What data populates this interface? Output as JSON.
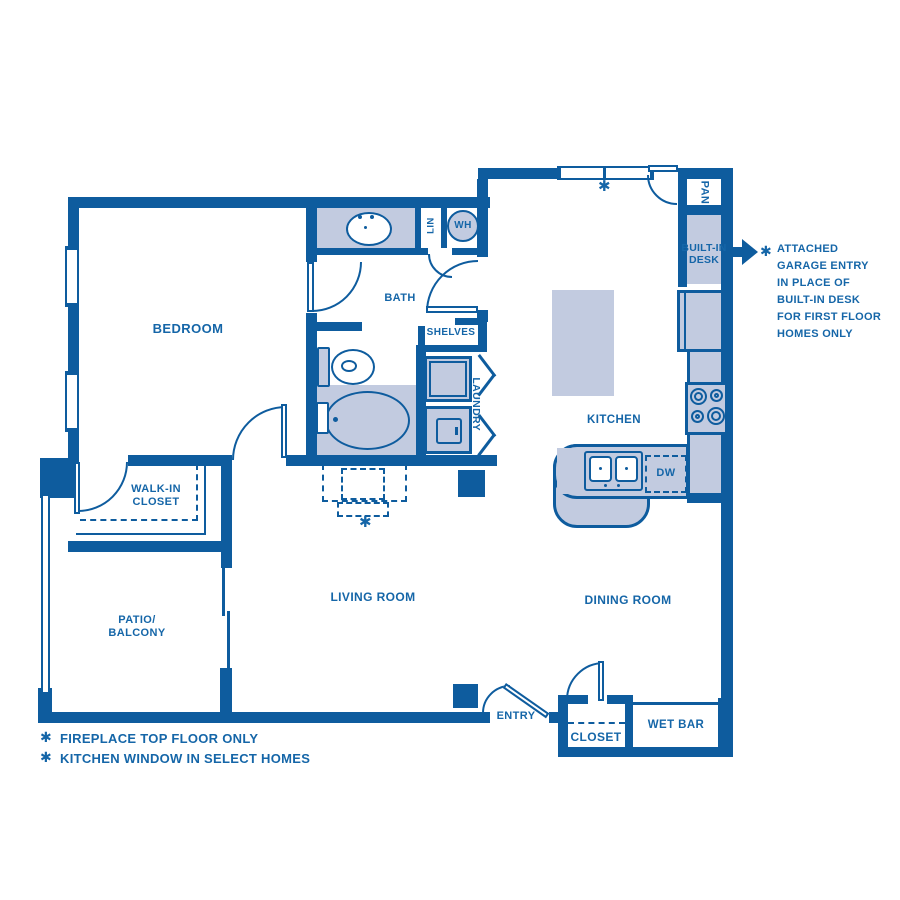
{
  "colors": {
    "wall": "#0E5C9E",
    "fill": "#C2CBE0",
    "label": "#1566A8"
  },
  "rooms": {
    "bedroom": "BEDROOM",
    "bath": "BATH",
    "kitchen": "KITCHEN",
    "living_room": "LIVING ROOM",
    "dining_room": "DINING ROOM",
    "walk_in_closet_line1": "WALK-IN",
    "walk_in_closet_line2": "CLOSET",
    "patio_line1": "PATIO/",
    "patio_line2": "BALCONY",
    "entry": "ENTRY",
    "closet": "CLOSET",
    "wet_bar": "WET BAR"
  },
  "fixtures": {
    "pantry": "PAN",
    "linen": "LIN",
    "water_heater": "WH",
    "shelves": "SHELVES",
    "laundry": "LAUNDRY",
    "dishwasher": "DW",
    "built_in_desk_line1": "BUILT-IN",
    "built_in_desk_line2": "DESK"
  },
  "annotation": {
    "star": "✱",
    "lines": [
      "ATTACHED",
      "GARAGE ENTRY",
      "IN PLACE OF",
      "BUILT-IN DESK",
      "FOR FIRST FLOOR",
      "HOMES ONLY"
    ]
  },
  "footnotes": [
    {
      "star": "✱",
      "text": "FIREPLACE TOP FLOOR ONLY"
    },
    {
      "star": "✱",
      "text": "KITCHEN WINDOW IN SELECT HOMES"
    }
  ],
  "symbols": {
    "star": "✱"
  }
}
